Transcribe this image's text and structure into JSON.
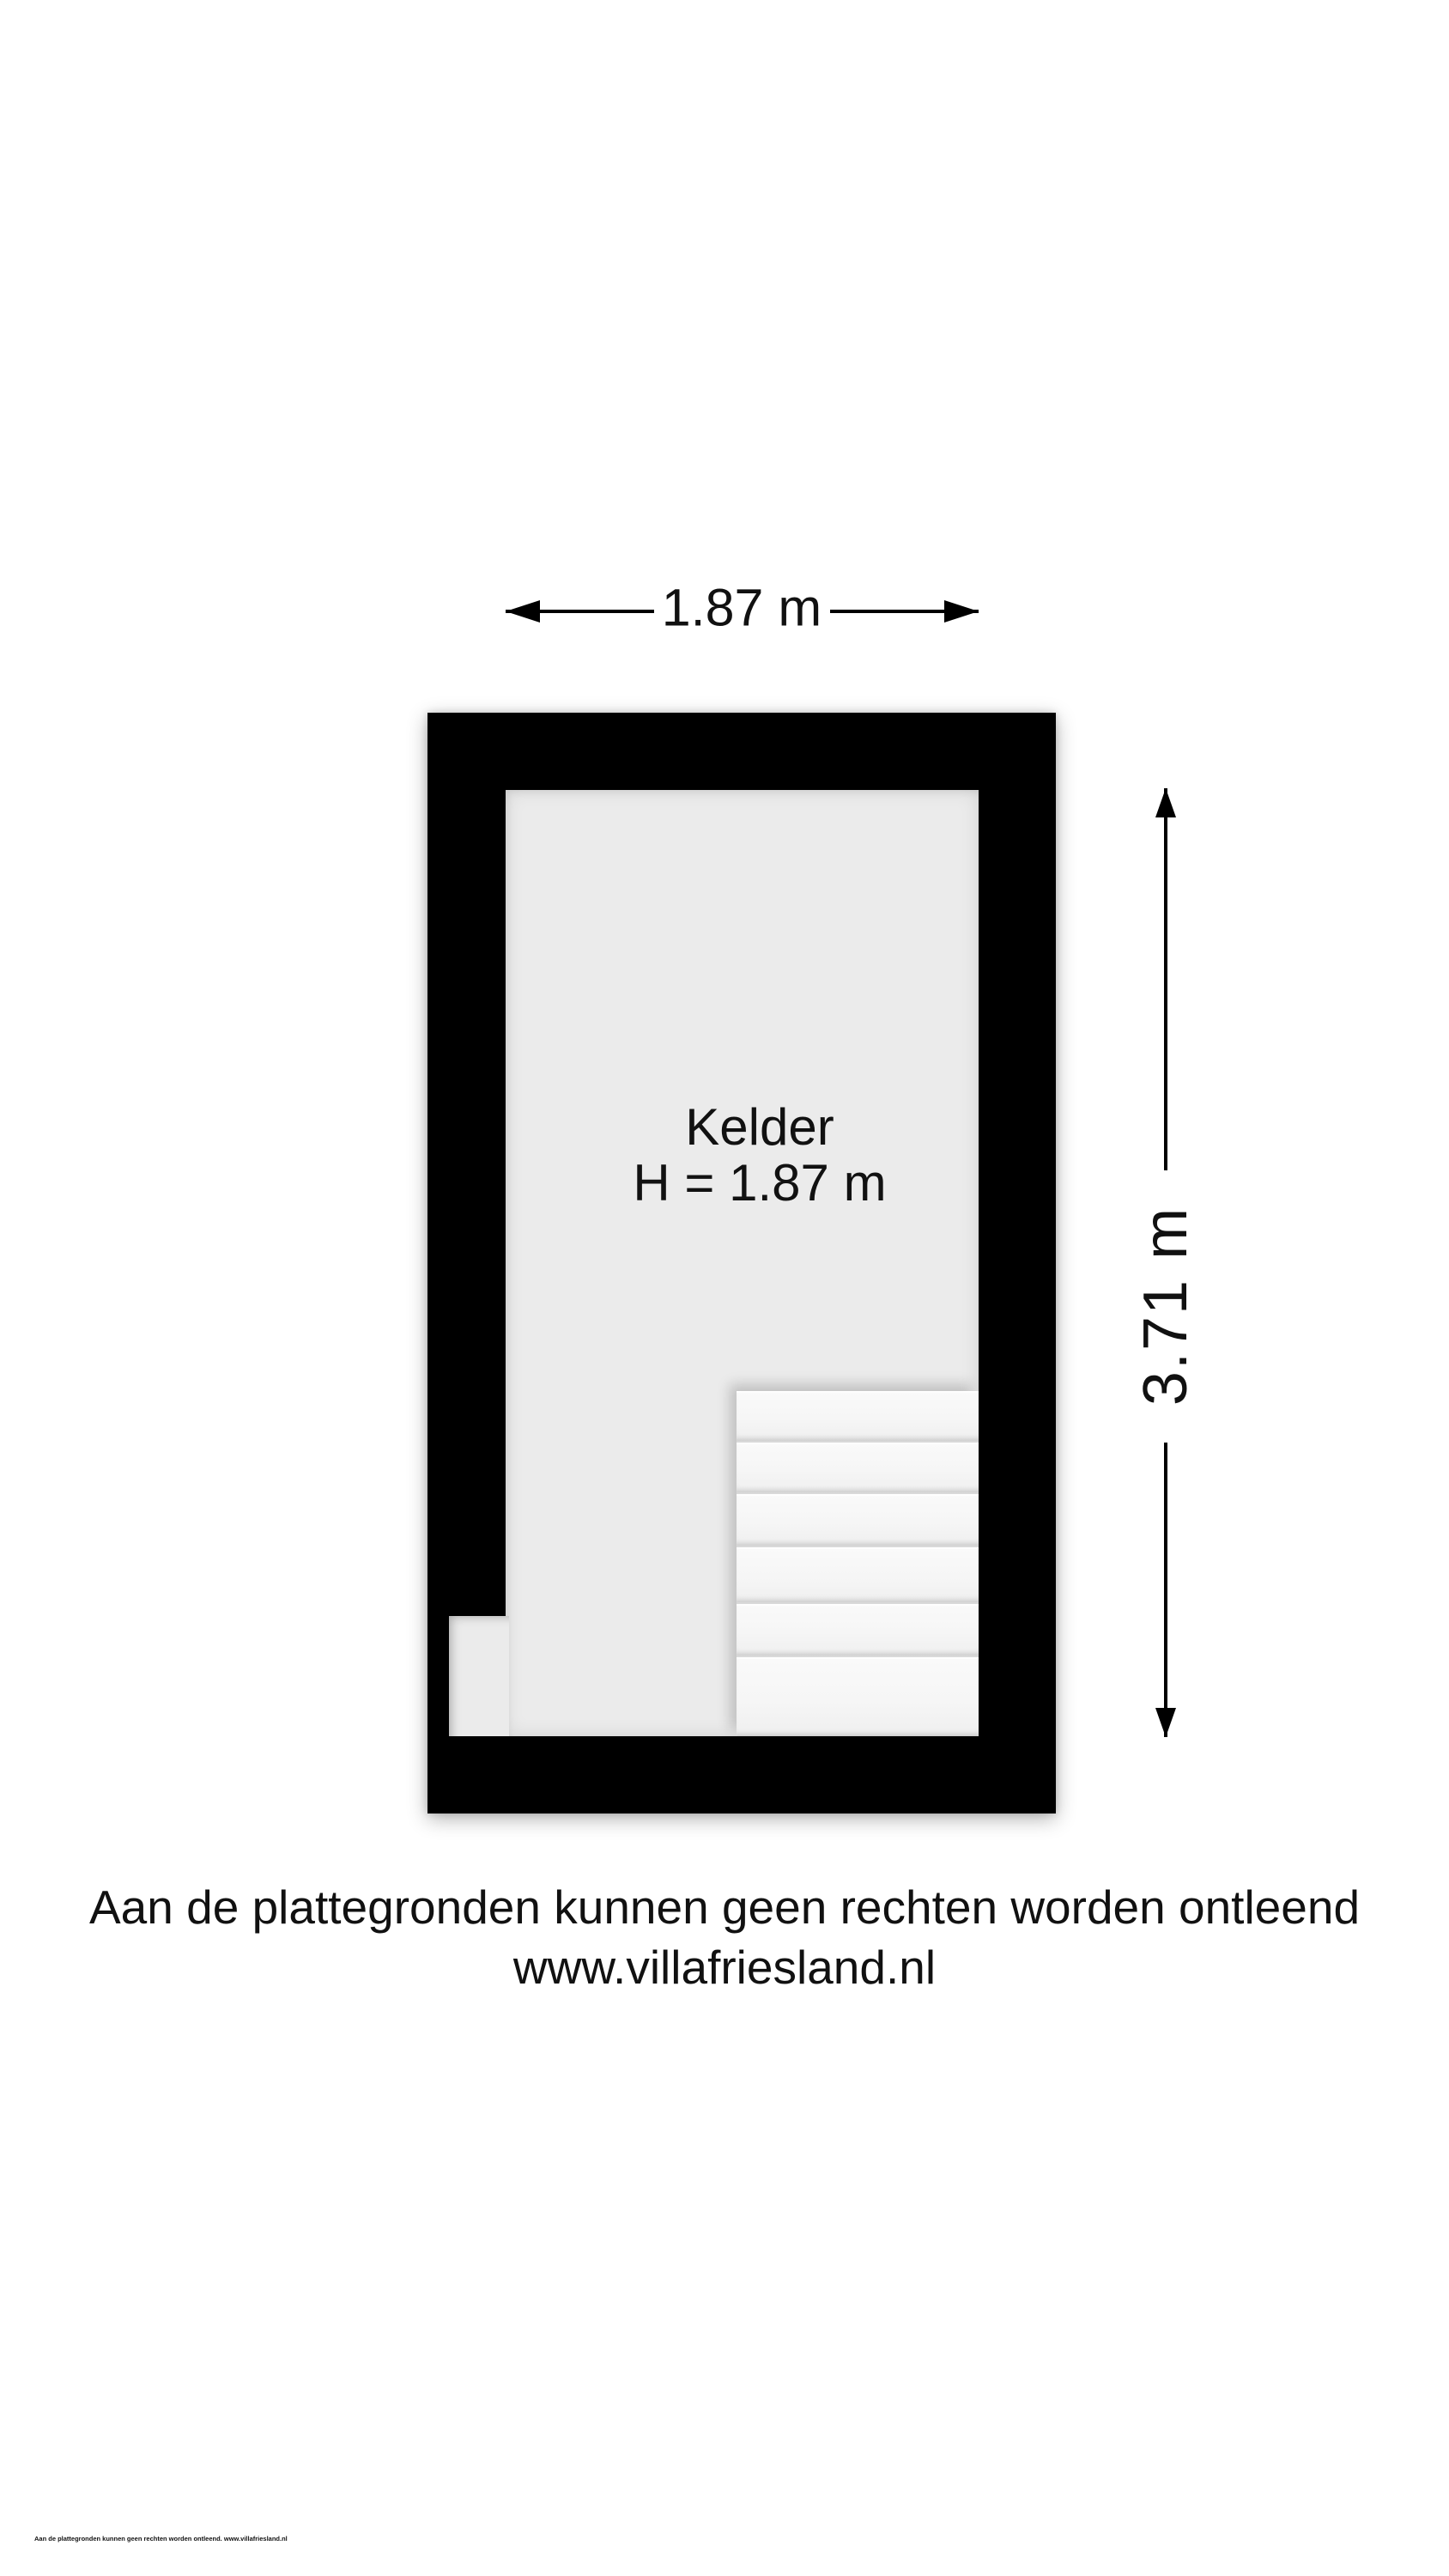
{
  "floorplan": {
    "room_label": "Kelder",
    "room_height_label": "H = 1.87 m",
    "width_dimension_label": "1.87 m",
    "height_dimension_label": "3.71 m",
    "stairs": {
      "tread_count": 6
    }
  },
  "footer": {
    "disclaimer": "Aan de plattegronden kunnen geen rechten worden ontleend",
    "website": "www.villafriesland.nl",
    "fineprint": "Aan de plattegronden kunnen geen rechten worden ontleend. www.villafriesland.nl"
  },
  "colors": {
    "wall": "#000000",
    "floor": "#ebebeb",
    "stair_tread": "#f6f6f6",
    "text": "#111111",
    "page_bg": "#ffffff"
  }
}
